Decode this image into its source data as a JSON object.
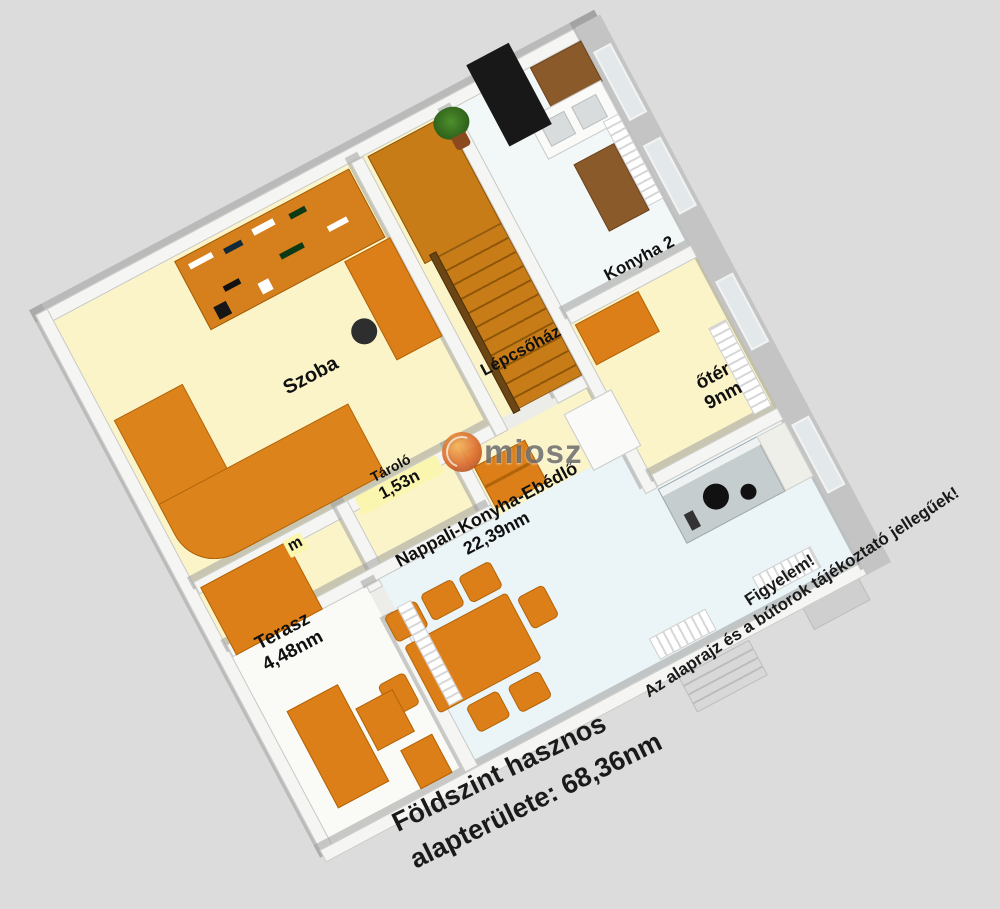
{
  "watermark": {
    "text": "miosz",
    "icon": "globe-icon"
  },
  "rooms": [
    {
      "name": "szoba",
      "label": "Szoba"
    },
    {
      "name": "lepcsohaz",
      "label": "Lépcsőház"
    },
    {
      "name": "konyha-2",
      "label": "Konyha 2"
    },
    {
      "name": "eloter",
      "label_visible": "őtér",
      "area_visible": "9nm"
    },
    {
      "name": "nappali-konyha-ebedlo",
      "label": "Nappali-Konyha-Ebédlő",
      "area": "22,39nm"
    },
    {
      "name": "tarolo",
      "label": "Tároló",
      "area_visible": "1,53n"
    },
    {
      "name": "terasz",
      "label": "Terasz",
      "area": "4,48nm"
    },
    {
      "name": "room-fragment",
      "label_visible": "m"
    }
  ],
  "annotations": {
    "footer": {
      "line1": "Földszint hasznos",
      "line2": "alapterülete: 68,36nm"
    },
    "notice": {
      "line1": "Figyelem!",
      "line2": "Az alaprajz és a bútorok tájékoztató jellegűek!"
    }
  },
  "colors": {
    "background": "#DCDCDC",
    "floor_yellow": "#FBF4C8",
    "floor_blue": "#EBF4F6",
    "floor_white": "#F2F7F7",
    "furniture_orange": "#DD7F18",
    "furniture_brown": "#8B5A2B",
    "wall_white": "#F5F5F3",
    "wall_gray": "#C4C4C4",
    "stairs": "#C87C17",
    "label_text": "#101010"
  }
}
